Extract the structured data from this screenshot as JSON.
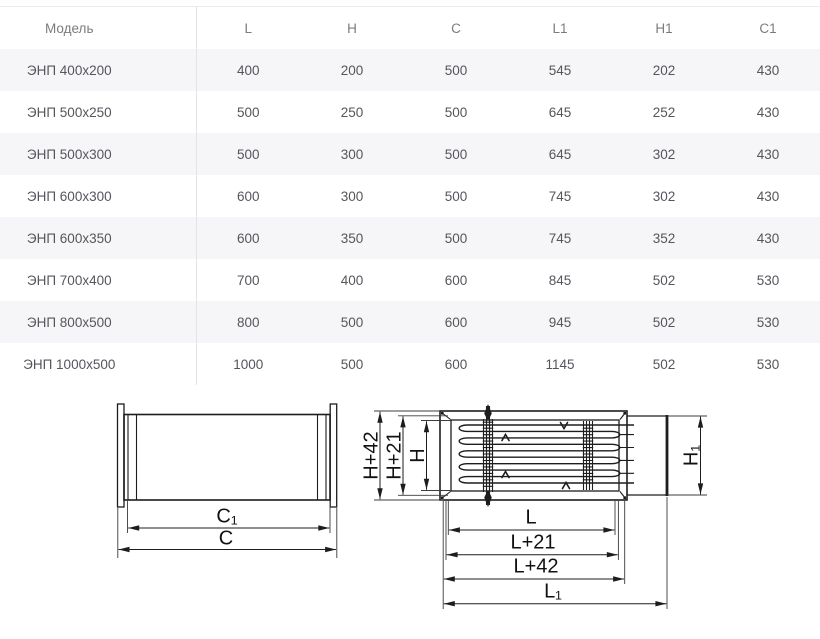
{
  "table": {
    "columns": [
      "Модель",
      "L",
      "H",
      "C",
      "L1",
      "H1",
      "C1"
    ],
    "rows": [
      [
        "ЭНП 400х200",
        "400",
        "200",
        "500",
        "545",
        "202",
        "430"
      ],
      [
        "ЭНП 500х250",
        "500",
        "250",
        "500",
        "645",
        "252",
        "430"
      ],
      [
        "ЭНП 500х300",
        "500",
        "300",
        "500",
        "645",
        "302",
        "430"
      ],
      [
        "ЭНП 600х300",
        "600",
        "300",
        "500",
        "745",
        "302",
        "430"
      ],
      [
        "ЭНП 600х350",
        "600",
        "350",
        "500",
        "745",
        "352",
        "430"
      ],
      [
        "ЭНП 700х400",
        "700",
        "400",
        "600",
        "845",
        "502",
        "530"
      ],
      [
        "ЭНП 800х500",
        "800",
        "500",
        "600",
        "945",
        "502",
        "530"
      ],
      [
        "ЭНП 1000х500",
        "1000",
        "500",
        "600",
        "1145",
        "502",
        "530"
      ]
    ]
  },
  "drawings": {
    "side_view": {
      "c1_label": "C₁",
      "c_label": "C"
    },
    "front_view": {
      "h42_label": "H+42",
      "h21_label": "H+21",
      "h_label": "H",
      "h1_label": "H₁",
      "l_label": "L",
      "l21_label": "L+21",
      "l42_label": "L+42",
      "l1_label": "L₁"
    }
  },
  "colors": {
    "row_stripe": "#f6f6f8",
    "cell_text": "#54565c",
    "header_text": "#7b7b80",
    "divider": "#e4e4e7",
    "drawing_line": "#1d1d1d"
  }
}
